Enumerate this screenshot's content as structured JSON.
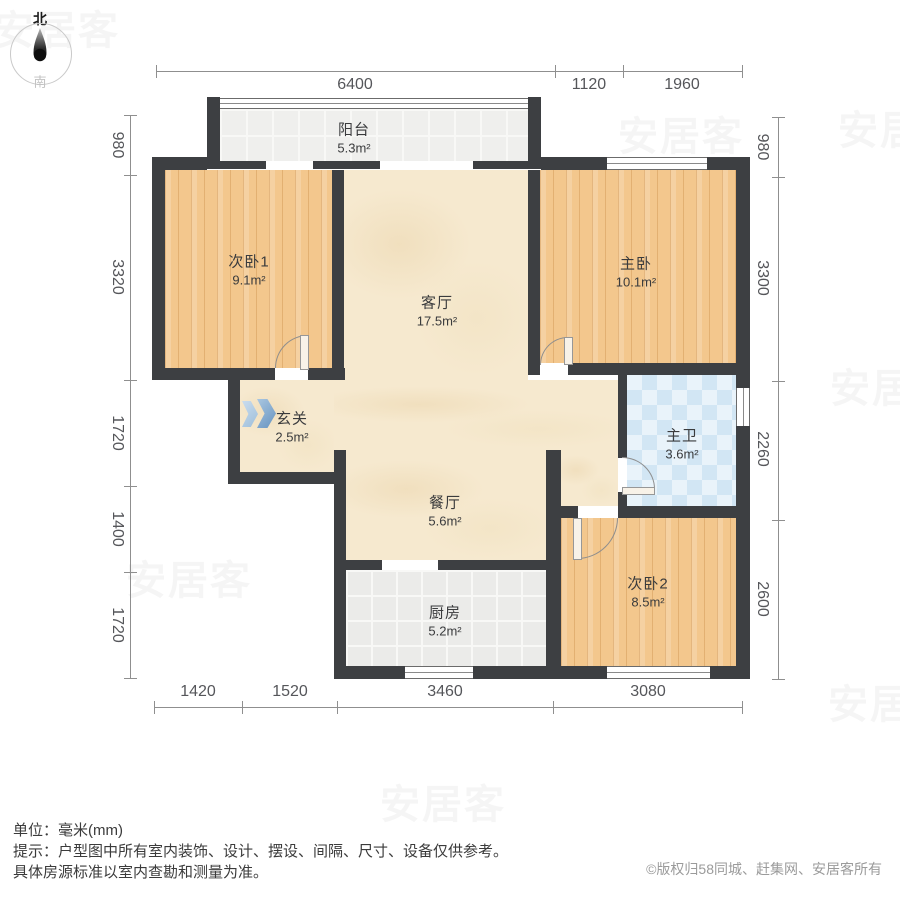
{
  "compass": {
    "north": "北",
    "south": "南"
  },
  "rooms": [
    {
      "name": "阳台",
      "area": "5.3m²"
    },
    {
      "name": "次卧1",
      "area": "9.1m²"
    },
    {
      "name": "客厅",
      "area": "17.5m²"
    },
    {
      "name": "主卧",
      "area": "10.1m²"
    },
    {
      "name": "玄关",
      "area": "2.5m²"
    },
    {
      "name": "主卫",
      "area": "3.6m²"
    },
    {
      "name": "餐厅",
      "area": "5.6m²"
    },
    {
      "name": "厨房",
      "area": "5.2m²"
    },
    {
      "name": "次卧2",
      "area": "8.5m²"
    }
  ],
  "dimensions": {
    "top": [
      "6400",
      "1120",
      "1960"
    ],
    "left": [
      "980",
      "3320",
      "1720",
      "1400",
      "1720"
    ],
    "right": [
      "980",
      "3300",
      "2260",
      "2600"
    ],
    "bottom": [
      "1420",
      "1520",
      "3460",
      "3080"
    ]
  },
  "footer": {
    "unit": "单位：毫米(mm)",
    "tip_line1": "提示：户型图中所有室内装饰、设计、摆设、间隔、尺寸、设备仅供参考。",
    "tip_line2": "具体房源标准以室内查勘和测量为准。",
    "copyright": "©版权归58同城、赶集网、安居客所有"
  },
  "watermark_text": "安居客",
  "colors": {
    "wall": "#3d3f42",
    "wood_floor": "#f3c78d",
    "marble_floor": "#f6e9cf",
    "tile_floor": "#ebebe9",
    "bath_tile": "#d2e6f4",
    "dimension_text": "#55565a",
    "copyright_text": "#9b9b9b",
    "arrow_blue": "#7ca3cb"
  }
}
